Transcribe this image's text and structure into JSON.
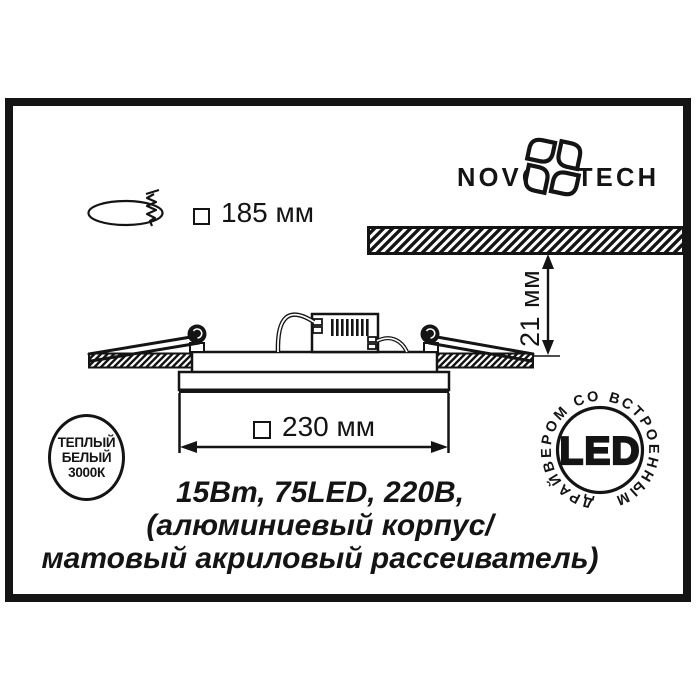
{
  "labels": {
    "cutout_dimension": "185 мм",
    "depth_dimension": "21 мм",
    "body_dimension": "230 мм"
  },
  "logo": {
    "left": "NOVO",
    "right": "TECH"
  },
  "badges": {
    "warm_white": {
      "line1": "ТЕПЛЫЙ",
      "line2": "БЕЛЫЙ",
      "line3": "3000К"
    },
    "led": {
      "center": "LED",
      "ring": "ДРАЙВЕРОМ СО ВСТРОЕННЫМ"
    }
  },
  "specs": {
    "line1": "15Вт, 75LED, 220В,",
    "line2": "(алюминиевый корпус/",
    "line3": "матовый акриловый рассеиватель)"
  },
  "icons": {
    "cutout": "ceiling-cutout-with-screw",
    "logo_emblem": "four-petal-pinwheel"
  },
  "colors": {
    "ink": "#141414",
    "paper": "#ffffff"
  }
}
